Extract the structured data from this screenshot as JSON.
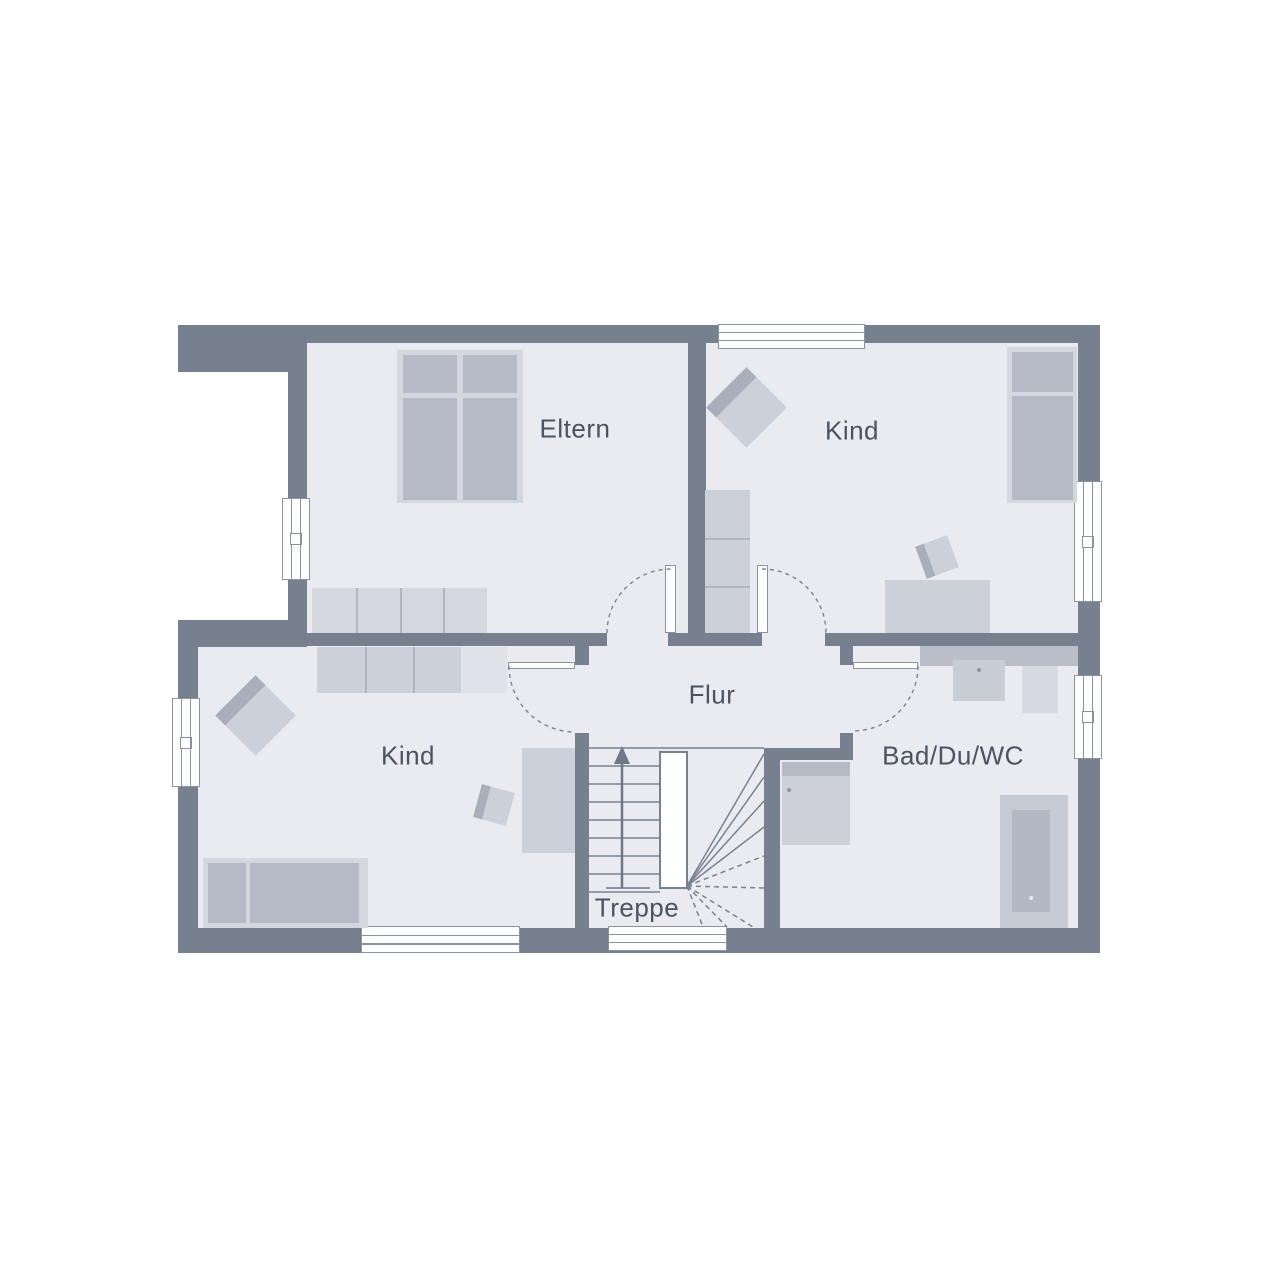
{
  "plan": {
    "type": "floor-plan",
    "rooms": {
      "eltern": {
        "label": "Eltern"
      },
      "kind_top": {
        "label": "Kind"
      },
      "kind_bottom": {
        "label": "Kind"
      },
      "flur": {
        "label": "Flur"
      },
      "bad": {
        "label": "Bad/Du/WC"
      },
      "treppe": {
        "label": "Treppe"
      }
    }
  },
  "palette": {
    "wall": "#76808E",
    "floor": "#E9EBF0",
    "furniture_light": "#D4D7DE",
    "furniture_medium": "#CCD0D9",
    "furniture_dark": "#B5BAC6",
    "furniture_xlight": "#DFE2E8",
    "counter": "#B9BEC9",
    "line": "#7B8492",
    "frame": "#8A93A0",
    "text": "#4B5260",
    "background": "#FFFFFF"
  }
}
